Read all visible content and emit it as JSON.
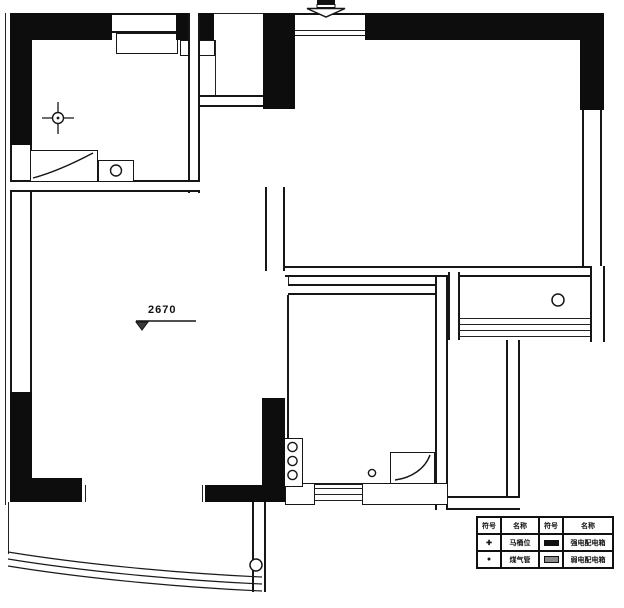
{
  "drawing": {
    "type": "residential floor plan (scanned blueprint)",
    "level_annotation": "2670"
  },
  "legend": {
    "headers": [
      "符号",
      "名称",
      "符号",
      "名称"
    ],
    "rows": [
      {
        "sym1": "✚",
        "name1": "马桶位",
        "sym2_icon": "strong-power-box-bar",
        "name2": "强电配电箱"
      },
      {
        "sym1": "●",
        "name1": "煤气管",
        "sym2_icon": "weak-power-box-bar",
        "name2": "弱电配电箱"
      }
    ]
  },
  "icons": {
    "entrance_arrow": "down-arrow",
    "toilet_position": "crosshair-circle",
    "floor_drain": "small-circle",
    "gas_pipes": "three-stacked-circles",
    "level_mark": "inverted-triangle-with-line"
  },
  "colors": {
    "background": "#ffffff",
    "wall_fill": "#0d0d0d",
    "line": "#1a1a1a"
  }
}
